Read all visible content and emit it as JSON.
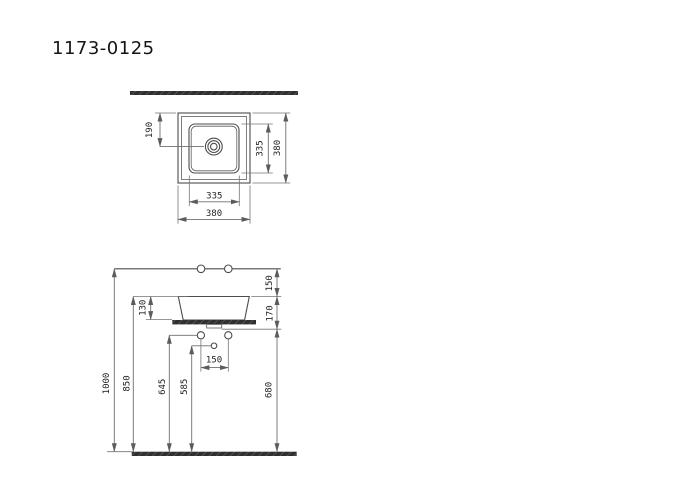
{
  "title": "1173-0125",
  "views": {
    "top_view_name": "top view",
    "front_view_name": "front elevation"
  },
  "dimensions": {
    "top_view": {
      "drain_offset": "190",
      "inner_depth": "335",
      "outer_depth": "380",
      "inner_width": "335",
      "outer_width": "380"
    },
    "front_view": {
      "faucet_above_rim": "150",
      "rim_to_counter_bottom": "170",
      "basin_depth": "130",
      "overall_height": "1000",
      "rim_height": "850",
      "supply_height": "645",
      "drain_height": "585",
      "counter_bottom_height": "680",
      "supply_spacing": "150"
    }
  },
  "colors": {
    "background": "#ffffff",
    "object_line": "#4c4c4c",
    "dimension_line": "#6f6f6f",
    "text": "#222222",
    "section_fill": "#30302e",
    "section_hatch": "#6a6a66"
  }
}
